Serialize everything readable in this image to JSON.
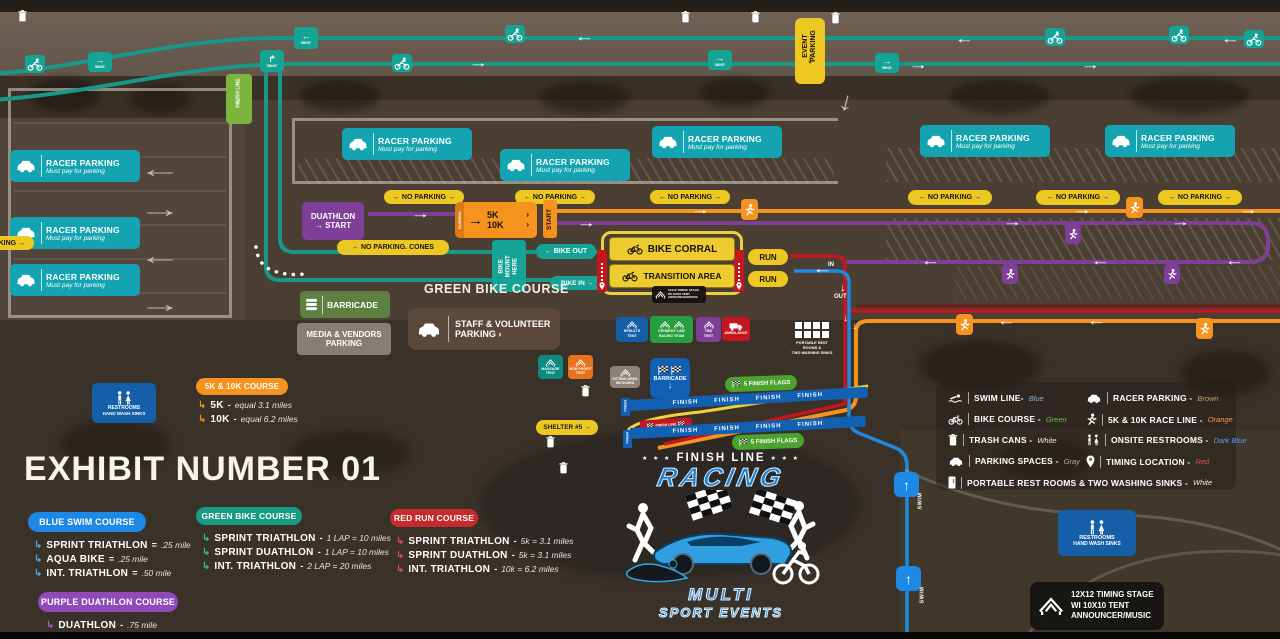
{
  "title": "EXHIBIT NUMBER 01",
  "colors": {
    "teal_sign": "#14a3b0",
    "teal_line": "#17988a",
    "yellow": "#edc722",
    "orange": "#f6921e",
    "purple": "#7d3f98",
    "red": "#c4161c",
    "blue": "#1e88e5",
    "dark_blue_sign": "#155fa8",
    "green_sign": "#5d8040",
    "bright_green": "#4aa32f",
    "swim_blue": "#7db6f0",
    "bike_green": "#6fbf57",
    "white": "#f2ede6",
    "gray": "#b5aba1",
    "brown": "#c79d72",
    "race_orange": "#f6a23e",
    "onsite_dark_blue": "#6b95f5",
    "timing_red": "#e05050"
  },
  "signs": {
    "event_parking_1": "EVENT",
    "event_parking_2": "PARKING",
    "finish_line_1": "FINISH",
    "finish_line_2": "LINE",
    "bike": "BIKE",
    "racer_title": "RACER PARKING",
    "racer_sub": "Must pay for parking",
    "no_parking": "← NO PARKING →",
    "no_parking_cones": "← NO PARKING. CONES",
    "duathlon1": "DUATHLON",
    "duathlon2": "→ START",
    "running": "RUNNING",
    "k5": "5K",
    "k10": "10K",
    "start": "START",
    "bike_out": "← BIKE OUT",
    "bike_in": "BIKE IN →",
    "bike_mount_1": "BIKE",
    "bike_mount_2": "MOUNT",
    "bike_mount_3": "HERE",
    "bike_corral": "BIKE CORRAL",
    "transition": "TRANSITION AREA",
    "run": "RUN",
    "in": "IN",
    "out": "OUT",
    "swim": "SWIM",
    "green_course_label": "GREEN BIKE COURSE",
    "barricade": "BARRICADE",
    "media1": "MEDIA & VENDORS",
    "media2": "PARKING",
    "staff1": "STAFF & VOLUNTEER",
    "staff2": "PARKING ›",
    "shelter": "SHELTER #5 →",
    "finish_flags": "5 FINISH FLAGS",
    "finish_repeat": "FINISH      FINISH      FINISH      FINISH",
    "finish_tag": "FINISH",
    "finish_banner": "FINISH LINE",
    "restrooms1": "RESTROOMS",
    "restrooms2": "HAND WASH SINKS",
    "timing1": "12X12 TIMING STAGE",
    "timing2": "WI 10X10 TENT",
    "timing3": "ANNOUNCER/MUSIC",
    "portable1": "PORTABLE REST",
    "portable2": "ROOMS &",
    "portable3": "TWO WASHING SINKS"
  },
  "tents": {
    "results1": "RESULTS",
    "results2": "TENT",
    "kennedy1": "KENNEDY LAW",
    "kennedy2": "RACING TEAM",
    "tbd1": "TBD",
    "tbd2": "TENT",
    "ambulance": "AMBULANCE",
    "massage1": "MASSAGE",
    "massage2": "TENT",
    "nonprofit1": "NON PROFIT",
    "nonprofit2": "TENT",
    "sitting1": "SITTING AREA",
    "sitting2": "W/CHAIRS"
  },
  "courses": {
    "orange": {
      "title": "5K & 10K COURSE",
      "items": [
        {
          "name": "5K",
          "sep": "-",
          "value": "equal 3.1 miles"
        },
        {
          "name": "10K",
          "sep": "-",
          "value": "equal 6.2 miles"
        }
      ]
    },
    "blue": {
      "title": "BLUE SWIM COURSE",
      "items": [
        {
          "name": "SPRINT TRIATHLON",
          "sep": "=",
          "value": ".25 mile"
        },
        {
          "name": "AQUA BIKE",
          "sep": "=",
          "value": ".25 mile"
        },
        {
          "name": "INT. TRIATHLON",
          "sep": "=",
          "value": ".50 mile"
        }
      ]
    },
    "green": {
      "title": "GREEN BIKE COURSE",
      "items": [
        {
          "name": "SPRINT TRIATHLON",
          "sep": "-",
          "value": "1 LAP = 10 miles"
        },
        {
          "name": "SPRINT DUATHLON",
          "sep": "-",
          "value": "1 LAP = 10 miles"
        },
        {
          "name": "INT. TRIATHLON",
          "sep": "-",
          "value": "2 LAP = 20 miles"
        }
      ]
    },
    "red": {
      "title": "RED RUN COURSE",
      "items": [
        {
          "name": "SPRINT TRIATHLON",
          "sep": "-",
          "value": "5k = 3.1 miles"
        },
        {
          "name": "SPRINT DUATHLON",
          "sep": "-",
          "value": "5k = 3.1 miles"
        },
        {
          "name": "INT. TRIATHLON",
          "sep": "-",
          "value": "10k = 6.2 miles"
        }
      ]
    },
    "purple": {
      "title": "PURPLE DUATHLON COURSE",
      "items": [
        {
          "name": "DUATHLON",
          "sep": "-",
          "value": ".75 mile"
        }
      ]
    }
  },
  "legend": {
    "left": [
      {
        "label": "SWIM LINE-",
        "value": "Blue"
      },
      {
        "label": "BIKE COURSE -",
        "value": "Green"
      },
      {
        "label": "TRASH CANS -",
        "value": "White"
      },
      {
        "label": "PARKING SPACES -",
        "value": "Gray"
      },
      {
        "label": "PORTABLE REST ROOMS & TWO WASHING SINKS -",
        "value": "White"
      }
    ],
    "right": [
      {
        "label": "RACER PARKING -",
        "value": "Brown"
      },
      {
        "label": "5K & 10K RACE LINE -",
        "value": "Orange"
      },
      {
        "label": "ONSITE RESTROOMS -",
        "value": "Dark Blue"
      },
      {
        "label": "TIMING LOCATION -",
        "value": "Red"
      }
    ]
  },
  "logo": {
    "stars": "★ ★ ★",
    "finish": "FINISH LINE",
    "racing": "RACING",
    "multi": "MULTI",
    "sport": "SPORT EVENTS"
  }
}
